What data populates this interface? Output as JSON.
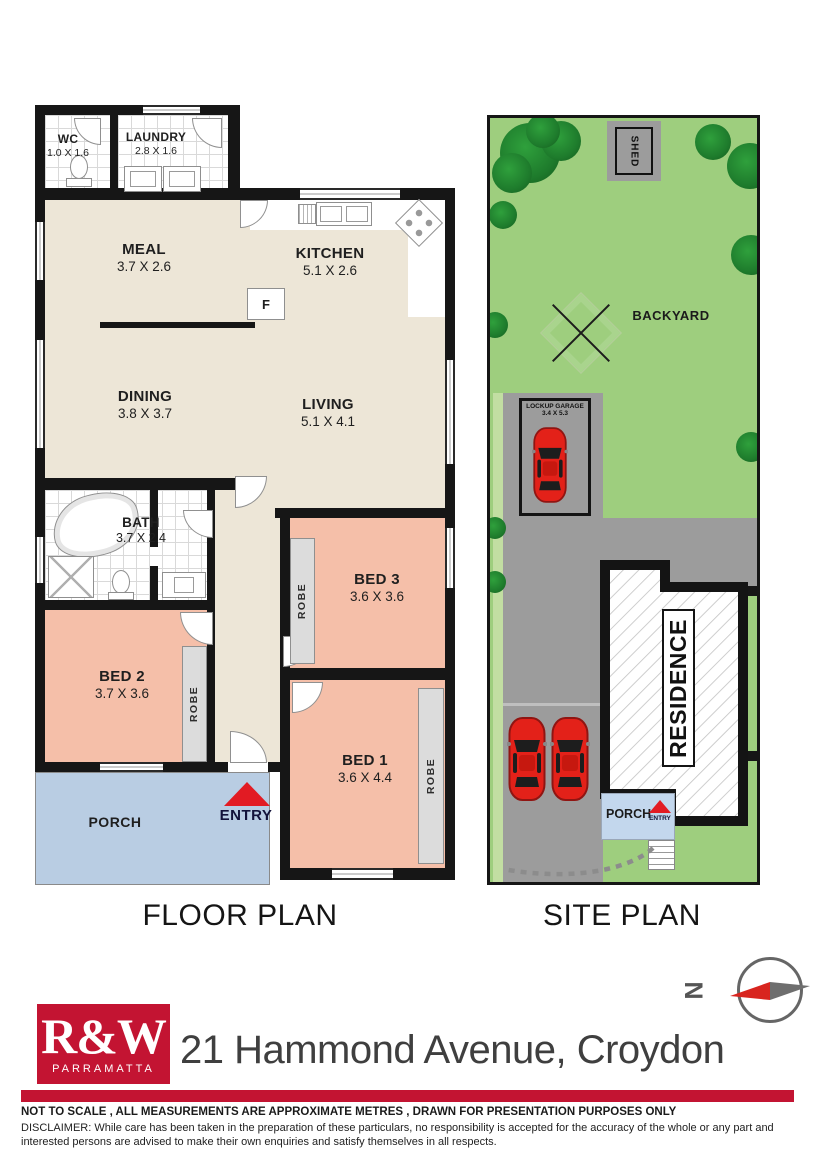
{
  "floor_plan": {
    "caption": "FLOOR PLAN",
    "rooms": [
      {
        "name": "WC",
        "dims": "1.0 X 1.6"
      },
      {
        "name": "LAUNDRY",
        "dims": "2.8 X 1.6"
      },
      {
        "name": "MEAL",
        "dims": "3.7 X 2.6"
      },
      {
        "name": "KITCHEN",
        "dims": "5.1 X 2.6"
      },
      {
        "name": "DINING",
        "dims": "3.8 X 3.7"
      },
      {
        "name": "LIVING",
        "dims": "5.1 X 4.1"
      },
      {
        "name": "BATH",
        "dims": "3.7 X 2.4"
      },
      {
        "name": "BED 2",
        "dims": "3.7 X 3.6"
      },
      {
        "name": "BED 3",
        "dims": "3.6 X 3.6"
      },
      {
        "name": "BED 1",
        "dims": "3.6 X 4.4"
      }
    ],
    "labels": {
      "porch": "PORCH",
      "entry": "ENTRY",
      "robe": "ROBE",
      "fridge": "F"
    }
  },
  "site_plan": {
    "caption": "SITE PLAN",
    "labels": {
      "shed": "SHED",
      "backyard": "BACKYARD",
      "garage_line1": "LOCKUP GARAGE",
      "garage_line2": "3.4 X 5.3",
      "residence": "RESIDENCE",
      "porch": "PORCH",
      "entry": "ENTRY"
    }
  },
  "compass": {
    "north": "N"
  },
  "footer": {
    "agency": "R&W",
    "branch": "PARRAMATTA",
    "address": "21 Hammond Avenue, Croydon",
    "scale_note": "NOT TO SCALE , ALL MEASUREMENTS ARE APPROXIMATE METRES , DRAWN FOR PRESENTATION PURPOSES ONLY",
    "disclaimer": "DISCLAIMER:  While care has been taken in the preparation of these particulars, no responsibility is accepted for the accuracy of the whole or any part and interested persons are advised to make their own enquiries and satisfy  themselves in all respects."
  },
  "colors": {
    "brand_red": "#C31432",
    "bedroom": "#F5BFA9",
    "floor": "#EDE6D7",
    "porch_blue": "#B9CDE3",
    "grass": "#9ECE7E",
    "paving": "#9C9C9C",
    "tree": "#237B2C"
  }
}
